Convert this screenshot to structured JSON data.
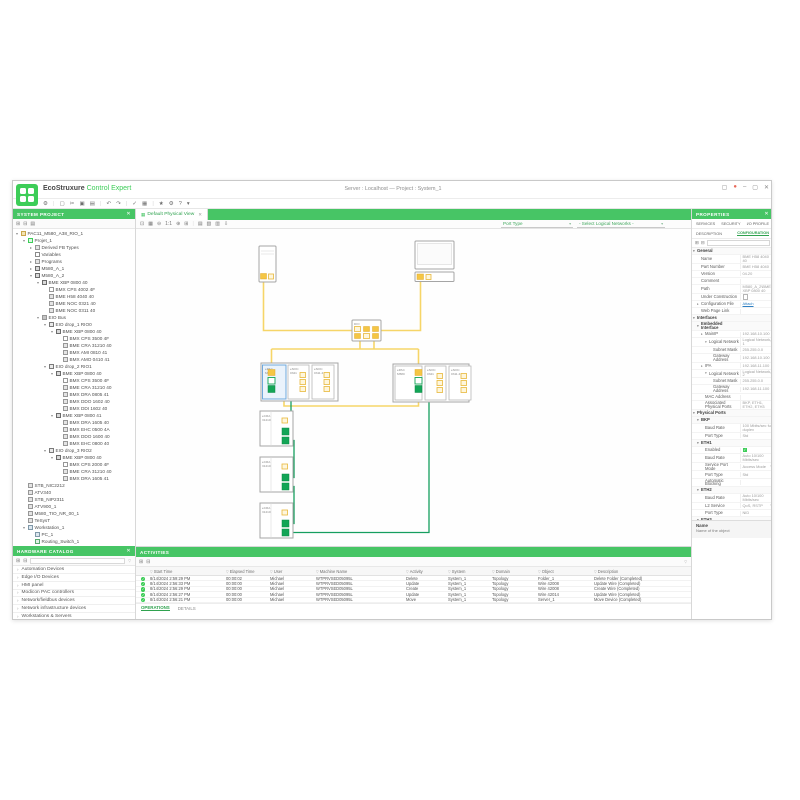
{
  "window": {
    "title": "Server : Localhost — Project : System_1",
    "brand_eco": "EcoStruxure",
    "brand_product": "Control Expert",
    "controls": [
      {
        "n": "layout-button",
        "g": "▢"
      },
      {
        "n": "account-button",
        "g": "●"
      },
      {
        "n": "minimize-button",
        "g": "–"
      },
      {
        "n": "maximize-button",
        "g": "▢"
      },
      {
        "n": "close-button",
        "g": "✕"
      }
    ]
  },
  "main_toolbar": {
    "icons": [
      {
        "n": "settings",
        "g": "⚙"
      },
      {
        "n": "separator",
        "g": "|"
      },
      {
        "n": "new-project",
        "g": "▢"
      },
      {
        "n": "cut",
        "g": "✂"
      },
      {
        "n": "copy",
        "g": "▣"
      },
      {
        "n": "paste",
        "g": "▤"
      },
      {
        "n": "separator",
        "g": "|"
      },
      {
        "n": "undo",
        "g": "↶"
      },
      {
        "n": "redo",
        "g": "↷"
      },
      {
        "n": "separator",
        "g": "|"
      },
      {
        "n": "validate",
        "g": "✓"
      },
      {
        "n": "build",
        "g": "▦"
      },
      {
        "n": "separator",
        "g": "|"
      },
      {
        "n": "favorites",
        "g": "★"
      },
      {
        "n": "options",
        "g": "⚙"
      },
      {
        "n": "help",
        "g": "?"
      },
      {
        "n": "more",
        "g": "▾"
      }
    ]
  },
  "system_project": {
    "header": "SYSTEM PROJECT",
    "close_glyph": "✕",
    "toolbar": [
      {
        "n": "expand-all",
        "g": "⊞"
      },
      {
        "n": "collapse-all",
        "g": "⊟"
      },
      {
        "n": "sync-selection",
        "g": "▤"
      }
    ],
    "tree": [
      {
        "t": "PAC11_M580_A38_RIO_1",
        "l": 0,
        "e": "▾",
        "ic": "folder"
      },
      {
        "t": "Projet_1",
        "l": 1,
        "e": "▾",
        "ic": "proj"
      },
      {
        "t": "Derived FB Types",
        "l": 2,
        "e": "▸",
        "ic": "dev"
      },
      {
        "t": "Variables",
        "l": 2,
        "e": "",
        "ic": "var"
      },
      {
        "t": "Programs",
        "l": 2,
        "e": "▸",
        "ic": "dev"
      },
      {
        "t": "M580_A_1",
        "l": 2,
        "e": "▸",
        "ic": "pac"
      },
      {
        "t": "M580_A_2",
        "l": 2,
        "e": "▾",
        "ic": "pac"
      },
      {
        "t": "BME XBP 0800 40",
        "l": 3,
        "e": "▾",
        "ic": "rack"
      },
      {
        "t": "BMX CPS 4002 4F",
        "l": 4,
        "e": "",
        "ic": "psu"
      },
      {
        "t": "BME H58 4040 40",
        "l": 4,
        "e": "",
        "ic": "dev"
      },
      {
        "t": "BME NOC 0321 40",
        "l": 4,
        "e": "",
        "ic": "dev"
      },
      {
        "t": "BME NOC 0311 40",
        "l": 4,
        "e": "",
        "ic": "dev"
      },
      {
        "t": "EIO Bus",
        "l": 3,
        "e": "▾",
        "ic": "bus"
      },
      {
        "t": "EIO drop_1 RIO0",
        "l": 4,
        "e": "▾",
        "ic": "drop"
      },
      {
        "t": "BME XBP 0800 40",
        "l": 5,
        "e": "▾",
        "ic": "rack"
      },
      {
        "t": "BMX CPS 3500 4F",
        "l": 6,
        "e": "",
        "ic": "psu"
      },
      {
        "t": "BME CRA 31210 40",
        "l": 6,
        "e": "",
        "ic": "dev"
      },
      {
        "t": "BMX AMI 0810 41",
        "l": 6,
        "e": "",
        "ic": "dev"
      },
      {
        "t": "BMX AMO 0410 41",
        "l": 6,
        "e": "",
        "ic": "dev"
      },
      {
        "t": "EIO drop_2 RIO1",
        "l": 4,
        "e": "▾",
        "ic": "drop"
      },
      {
        "t": "BME XBP 0800 40",
        "l": 5,
        "e": "▾",
        "ic": "rack"
      },
      {
        "t": "BMX CPS 3500 4F",
        "l": 6,
        "e": "",
        "ic": "psu"
      },
      {
        "t": "BME CRA 31210 40",
        "l": 6,
        "e": "",
        "ic": "dev"
      },
      {
        "t": "BMX DRA 0805 41",
        "l": 6,
        "e": "",
        "ic": "dev"
      },
      {
        "t": "BMX DDO 1602 40",
        "l": 6,
        "e": "",
        "ic": "dev"
      },
      {
        "t": "BMX DDI 1602 40",
        "l": 6,
        "e": "",
        "ic": "dev"
      },
      {
        "t": "BME XBP 0800 41",
        "l": 5,
        "e": "▾",
        "ic": "rack"
      },
      {
        "t": "BMX DRA 1605 40",
        "l": 6,
        "e": "",
        "ic": "dev"
      },
      {
        "t": "BMX EHC 0500 4A",
        "l": 6,
        "e": "",
        "ic": "dev"
      },
      {
        "t": "BMX DDO 1600 40",
        "l": 6,
        "e": "",
        "ic": "dev"
      },
      {
        "t": "BMX EHC 0800 40",
        "l": 6,
        "e": "",
        "ic": "dev"
      },
      {
        "t": "EIO drop_3 RIO2",
        "l": 4,
        "e": "▾",
        "ic": "drop"
      },
      {
        "t": "BME XBP 0800 40",
        "l": 5,
        "e": "▾",
        "ic": "rack"
      },
      {
        "t": "BMX CPS 2000 4F",
        "l": 6,
        "e": "",
        "ic": "psu"
      },
      {
        "t": "BME CRA 31210 40",
        "l": 6,
        "e": "",
        "ic": "dev"
      },
      {
        "t": "BMX DRA 1605 41",
        "l": 6,
        "e": "",
        "ic": "dev"
      },
      {
        "t": "STB_NIC2212",
        "l": 1,
        "e": "",
        "ic": "dev"
      },
      {
        "t": "ATV340",
        "l": 1,
        "e": "",
        "ic": "dev"
      },
      {
        "t": "STB_NIP2311",
        "l": 1,
        "e": "",
        "ic": "dev"
      },
      {
        "t": "ATV900_1",
        "l": 1,
        "e": "",
        "ic": "dev"
      },
      {
        "t": "M580_TIO_NR_00_1",
        "l": 1,
        "e": "",
        "ic": "dev"
      },
      {
        "t": "TeSysT",
        "l": 1,
        "e": "",
        "ic": "dev"
      },
      {
        "t": "Workstation_1",
        "l": 1,
        "e": "▾",
        "ic": "ws"
      },
      {
        "t": "PC_1",
        "l": 2,
        "e": "",
        "ic": "pc"
      },
      {
        "t": "Routing_Switch_1",
        "l": 2,
        "e": "",
        "ic": "sw"
      }
    ]
  },
  "catalog": {
    "header": "HARDWARE CATALOG",
    "close_glyph": "✕",
    "toolbar": [
      {
        "n": "expand-all",
        "g": "⊞"
      },
      {
        "n": "collapse-all",
        "g": "⊟"
      }
    ],
    "funnel": "▽",
    "chevron": "›",
    "items": [
      {
        "t": "Automation Devices"
      },
      {
        "t": "Edge I/O Devices"
      },
      {
        "t": "HMI panel"
      },
      {
        "t": "Modicon PAC controllers"
      },
      {
        "t": "Network/fieldbus devices"
      },
      {
        "t": "Network infrastructure devices"
      },
      {
        "t": "Workstations & Servers"
      }
    ]
  },
  "view": {
    "tab": "Default Physical View",
    "tab_icon": "▦",
    "tab_close": "✕",
    "toolbar": [
      {
        "n": "fit-view",
        "g": "⊡"
      },
      {
        "n": "toggle-grid",
        "g": "▦"
      },
      {
        "n": "zoom-out",
        "g": "⊖"
      },
      {
        "n": "zoom-level",
        "g": "1:1"
      },
      {
        "n": "zoom-in",
        "g": "⊕"
      },
      {
        "n": "zoom-area",
        "g": "⊞"
      },
      {
        "n": "separator",
        "g": "|"
      },
      {
        "n": "export-view",
        "g": "▤"
      },
      {
        "n": "snapshot",
        "g": "▧"
      },
      {
        "n": "print",
        "g": "▥"
      },
      {
        "n": "download",
        "g": "⇩"
      }
    ],
    "port_type_label": "Port Type",
    "network_filter_label": "- Select Logical Networks -",
    "caret": "▾"
  },
  "topology": {
    "switch_label": "DIO",
    "left_rack_modules": [
      {
        "l1": "ePAC",
        "l2": "M580"
      },
      {
        "l1": "eNOC",
        "l2": "0321"
      },
      {
        "l1": "eNOC",
        "l2": "0311.4"
      }
    ],
    "right_rack_modules": [
      {
        "l1": "ePAC",
        "l2": "M580"
      },
      {
        "l1": "eNOC",
        "l2": "0321"
      },
      {
        "l1": "eNOC",
        "l2": "0311.4"
      }
    ],
    "drops": [
      {
        "l1": "eCRA",
        "l2": "31210"
      },
      {
        "l1": "eCRA",
        "l2": "31210"
      },
      {
        "l1": "eCRA",
        "l2": "31210"
      }
    ]
  },
  "activities": {
    "header": "ACTIVITIES",
    "toolbar": [
      {
        "n": "export-log",
        "g": "⊞"
      },
      {
        "n": "refresh-log",
        "g": "⊟"
      }
    ],
    "funnel": "▽",
    "columns": [
      {
        "t": "Start Time"
      },
      {
        "t": "Elapsed Time"
      },
      {
        "t": "User"
      },
      {
        "t": "Machine Name"
      },
      {
        "t": "Activity"
      },
      {
        "t": "System"
      },
      {
        "t": "Domain"
      },
      {
        "t": "Object"
      },
      {
        "t": "Description"
      }
    ],
    "rows": [
      {
        "time": "8/14/2024 2:59:29 PM",
        "elapsed": "00:00:02",
        "user": "Michael",
        "machine": "WTPRVSED05095L",
        "activity": "Delete",
        "system": "System_1",
        "domain": "Topology",
        "object": "Folder_1",
        "desc": "Delete Folder (Completed)",
        "status": "✓"
      },
      {
        "time": "8/14/2024 2:56:33 PM",
        "elapsed": "00:00:00",
        "user": "Michael",
        "machine": "WTPRVSED05095L",
        "activity": "Update",
        "system": "System_1",
        "domain": "Topology",
        "object": "Wire 42008",
        "desc": "Update Wire (Completed)",
        "status": "✓"
      },
      {
        "time": "8/14/2024 2:56:29 PM",
        "elapsed": "00:00:00",
        "user": "Michael",
        "machine": "WTPRVSED05095L",
        "activity": "Create",
        "system": "System_1",
        "domain": "Topology",
        "object": "Wire 42008",
        "desc": "Create Wire (Completed)",
        "status": "✓"
      },
      {
        "time": "8/14/2024 2:56:27 PM",
        "elapsed": "00:00:00",
        "user": "Michael",
        "machine": "WTPRVSED05095L",
        "activity": "Update",
        "system": "System_1",
        "domain": "Topology",
        "object": "Wire 42014",
        "desc": "Update Wire (Completed)",
        "status": "✓"
      },
      {
        "time": "8/14/2024 2:56:21 PM",
        "elapsed": "00:00:00",
        "user": "Michael",
        "machine": "WTPRVSED05095L",
        "activity": "Move",
        "system": "System_1",
        "domain": "Topology",
        "object": "Server_1",
        "desc": "Move Device (Completed)",
        "status": "✓"
      }
    ],
    "tabs": [
      {
        "t": "OPERATIONS"
      },
      {
        "t": "DETAILS"
      }
    ]
  },
  "properties": {
    "header": "PROPERTIES",
    "close_glyph": "✕",
    "tabs_top": [
      {
        "t": "SERVICES"
      },
      {
        "t": "SECURITY"
      },
      {
        "t": "I/O PROFILE"
      }
    ],
    "tabs_sub": [
      {
        "t": "DESCRIPTION"
      },
      {
        "t": "CONFIGURATION"
      }
    ],
    "toolbar": [
      {
        "n": "expand-all",
        "g": "⊞"
      },
      {
        "n": "collapse-all",
        "g": "⊟"
      }
    ],
    "rows": [
      {
        "label": "General",
        "lv": 0,
        "e": "▾",
        "vk": "sec"
      },
      {
        "label": "Name",
        "value": "BME H58 4040 40",
        "lv": 1
      },
      {
        "label": "Part Number",
        "value": "BME H58 4040",
        "lv": 1
      },
      {
        "label": "Version",
        "value": "04.20",
        "lv": 1
      },
      {
        "label": "Comment",
        "value": "",
        "lv": 1
      },
      {
        "label": "Path",
        "value": "M580_A_2\\BME XBP 0800 40",
        "lv": 1
      },
      {
        "label": "Under Construction",
        "lv": 1,
        "vk": "check"
      },
      {
        "label": "Configuration File",
        "value": "Attach",
        "lv": 1,
        "e": "▸",
        "vk": "link"
      },
      {
        "label": "Web Page Link",
        "value": "",
        "lv": 1
      },
      {
        "label": "Interfaces",
        "lv": 0,
        "e": "▾",
        "vk": "sec"
      },
      {
        "label": "Embedded Interface",
        "lv": 1,
        "e": "▾",
        "vk": "sec"
      },
      {
        "label": "MainIP",
        "value": "192.168.10.100",
        "lv": 2,
        "e": "▸"
      },
      {
        "label": "Logical Network",
        "value": "Logical Network 1",
        "lv": 3,
        "e": "▾",
        "vk": "dd"
      },
      {
        "label": "Subnet Mask",
        "value": "255.255.0.0",
        "lv": 4
      },
      {
        "label": "Gateway Address",
        "value": "192.168.10.100",
        "lv": 4
      },
      {
        "label": "IPA",
        "value": "192.168.11.100",
        "lv": 2,
        "e": "▸"
      },
      {
        "label": "Logical Network",
        "value": "Logical Network 2",
        "lv": 3,
        "e": "▾",
        "vk": "dd"
      },
      {
        "label": "Subnet Mask",
        "value": "255.255.0.0",
        "lv": 4
      },
      {
        "label": "Gateway Address",
        "value": "192.168.11.100",
        "lv": 4
      },
      {
        "label": "MAC Address",
        "value": "",
        "lv": 2
      },
      {
        "label": "Associated Physical Ports",
        "value": "BKP, ETH1, ETH2, ETH3",
        "lv": 2
      },
      {
        "label": "Physical Ports",
        "lv": 0,
        "e": "▾",
        "vk": "sec"
      },
      {
        "label": "BKP",
        "lv": 1,
        "e": "▾",
        "vk": "sec"
      },
      {
        "label": "Baud Rate",
        "value": "100 Mbits/sec full duplex",
        "lv": 2
      },
      {
        "label": "Port Type",
        "value": "Std",
        "lv": 2
      },
      {
        "label": "ETH1",
        "lv": 1,
        "e": "▾",
        "vk": "sec"
      },
      {
        "label": "Enabled",
        "lv": 2,
        "vk": "checked"
      },
      {
        "label": "Baud Rate",
        "value": "Auto 10/100 Mbits/sec",
        "lv": 2
      },
      {
        "label": "Service Port Mode",
        "value": "Access Mode",
        "lv": 2,
        "vk": "dd"
      },
      {
        "label": "Port Type",
        "value": "Std",
        "lv": 2
      },
      {
        "label": "Automatic Blocking",
        "value": "",
        "lv": 2
      },
      {
        "label": "ETH2",
        "lv": 1,
        "e": "▾",
        "vk": "sec"
      },
      {
        "label": "Baud Rate",
        "value": "Auto 10/100 Mbits/sec",
        "lv": 2
      },
      {
        "label": "L2 Service",
        "value": "QoS, RSTP",
        "lv": 2,
        "vk": "dd"
      },
      {
        "label": "Port Type",
        "value": "NID",
        "lv": 2
      },
      {
        "label": "ETH3",
        "lv": 1,
        "e": "▾",
        "vk": "sec"
      },
      {
        "label": "Baud Rate",
        "value": "Auto 10/100 Mbits/sec",
        "lv": 2
      },
      {
        "label": "L2 Service",
        "value": "QoS, RSTP",
        "lv": 2,
        "vk": "dd"
      }
    ],
    "help_title": "Name",
    "help_text": "Name of the object"
  },
  "colors": {
    "brand_green": "#3DCD58",
    "bar_green": "#47C565",
    "wire_yellow": "#F6D568",
    "port_yellow": "#F5C644",
    "wire_green": "#169E5F",
    "port_green": "#12A556",
    "selection_blue": "#6FA8DC",
    "link_blue": "#2F80C3",
    "status_ok_green": "#3DCD58",
    "account_dot": "#E8695A"
  }
}
